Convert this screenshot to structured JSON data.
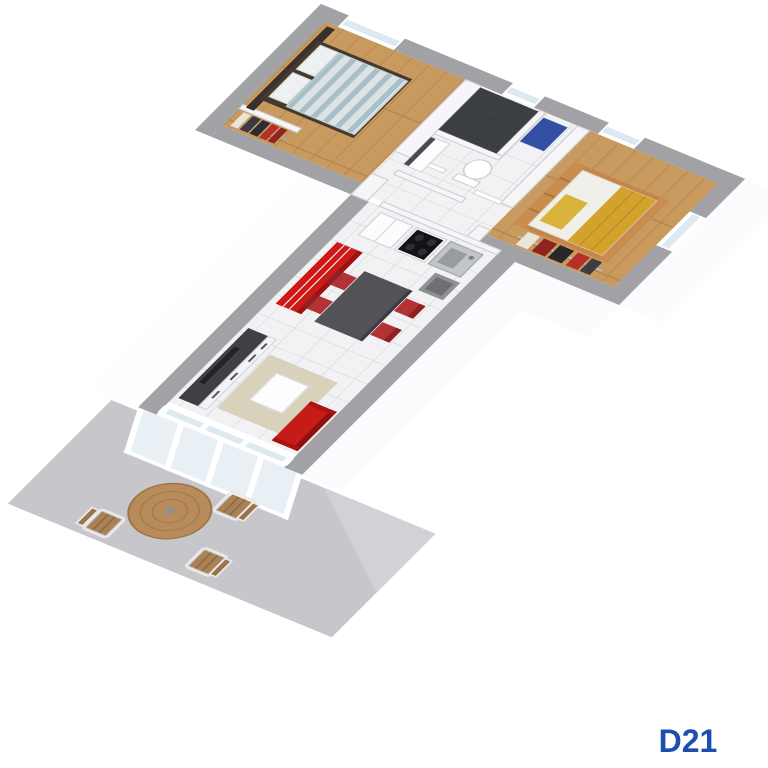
{
  "label": {
    "text": "D21",
    "color": "#1d4fae"
  },
  "palette": {
    "background": "#ffffff",
    "wall_top": "#a2a2a6",
    "wall_face": "#ffffff",
    "partition": "#f6f6f8",
    "tile": "#f2f2f4",
    "tile_line": "#dadade",
    "wood": "#c99a5f",
    "wood_line": "#b1824a",
    "shower_dark": "#3c4045",
    "mat_blue": "#3350a5",
    "accent_red": "#d01814",
    "accent_red_dark": "#a01010",
    "chair_red": "#b23236",
    "chair_red_dark": "#8f2024",
    "sofa_red": "#c51c18",
    "table_gray": "#525257",
    "tv_dark": "#3f3f44",
    "rug_beige": "#d8d2bd",
    "bed_frame_dark": "#463a2e",
    "headboard_dark": "#37302d",
    "duvet_light": "#dbe3e5",
    "duvet_stripe": "#a9bfc7",
    "pillow_white": "#eef1f1",
    "bed2_wood": "#c6854a",
    "bed_yellow": "#d9b33c",
    "throw_yellow": "#d2a22c",
    "mattress_white": "#f0efe9",
    "steel": "#c3c6c9",
    "cooktop_black": "#141417",
    "terrace_slab": "#c6c6cb",
    "terrace_slab_light": "#d2d2d6",
    "terrace_wood": "#b78c5a",
    "chair_wood": "#ab8156",
    "glass": "#dce9f0",
    "glass_face": "#e9f0f5"
  },
  "scene": {
    "type": "isometric-floor-plan",
    "rooms": [
      "bedroom-1",
      "bathroom",
      "hallway",
      "bedroom-2",
      "living-kitchen",
      "terrace"
    ],
    "furniture": {
      "bedroom_1": [
        "double-bed",
        "headboard-panel",
        "wardrobe-clothes"
      ],
      "bathroom": [
        "shower",
        "toilet",
        "washbasin",
        "bath-mat"
      ],
      "bedroom_2": [
        "single-bed",
        "clothes-rail"
      ],
      "kitchen": [
        "fridge",
        "stove",
        "sink",
        "vent-column"
      ],
      "living": [
        "red-sideboard",
        "tv-unit",
        "tv",
        "dining-table",
        "dining-chairs",
        "sofa",
        "rug",
        "coffee-table",
        "glass-doors"
      ],
      "terrace": [
        "round-table",
        "terrace-chairs"
      ]
    },
    "counts": {
      "dining_chairs": 4,
      "terrace_chairs": 3
    }
  }
}
